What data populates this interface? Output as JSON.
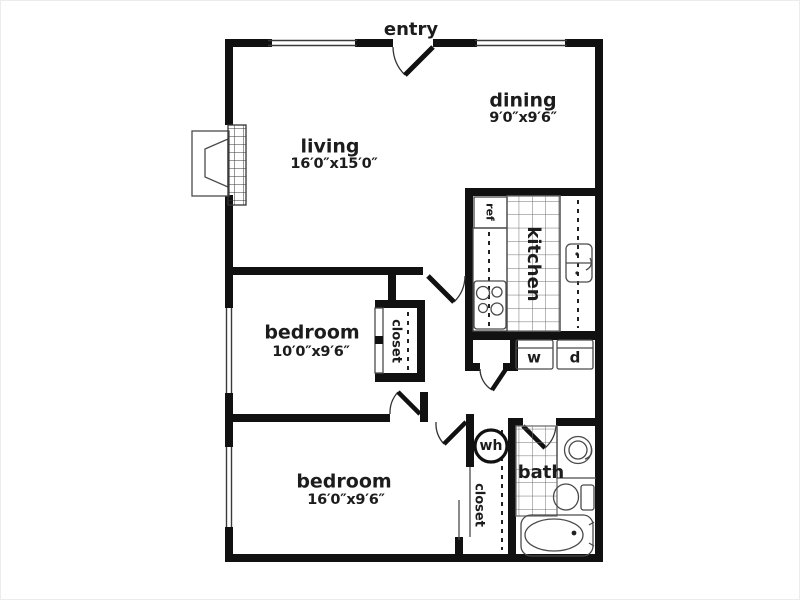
{
  "title": "apartment floor plan",
  "labels": {
    "entry": "entry",
    "living": {
      "name": "living",
      "dims": "16′0″x15′0″"
    },
    "dining": {
      "name": "dining",
      "dims": "9′0″x9′6″"
    },
    "bedroom1": {
      "name": "bedroom",
      "dims": "10′0″x9′6″"
    },
    "bedroom2": {
      "name": "bedroom",
      "dims": "16′0″x9′6″"
    },
    "kitchen": "kitchen",
    "bath": "bath",
    "refrigerator": "ref",
    "washer": "w",
    "dryer": "d",
    "water_heater": "wh",
    "bedroom1_closet": "closet",
    "bedroom2_closet": "closet"
  },
  "colors": {
    "wall": "#111111",
    "fixture_line": "#4a4a4a",
    "background": "#ffffff",
    "text": "#1c1c1c"
  }
}
